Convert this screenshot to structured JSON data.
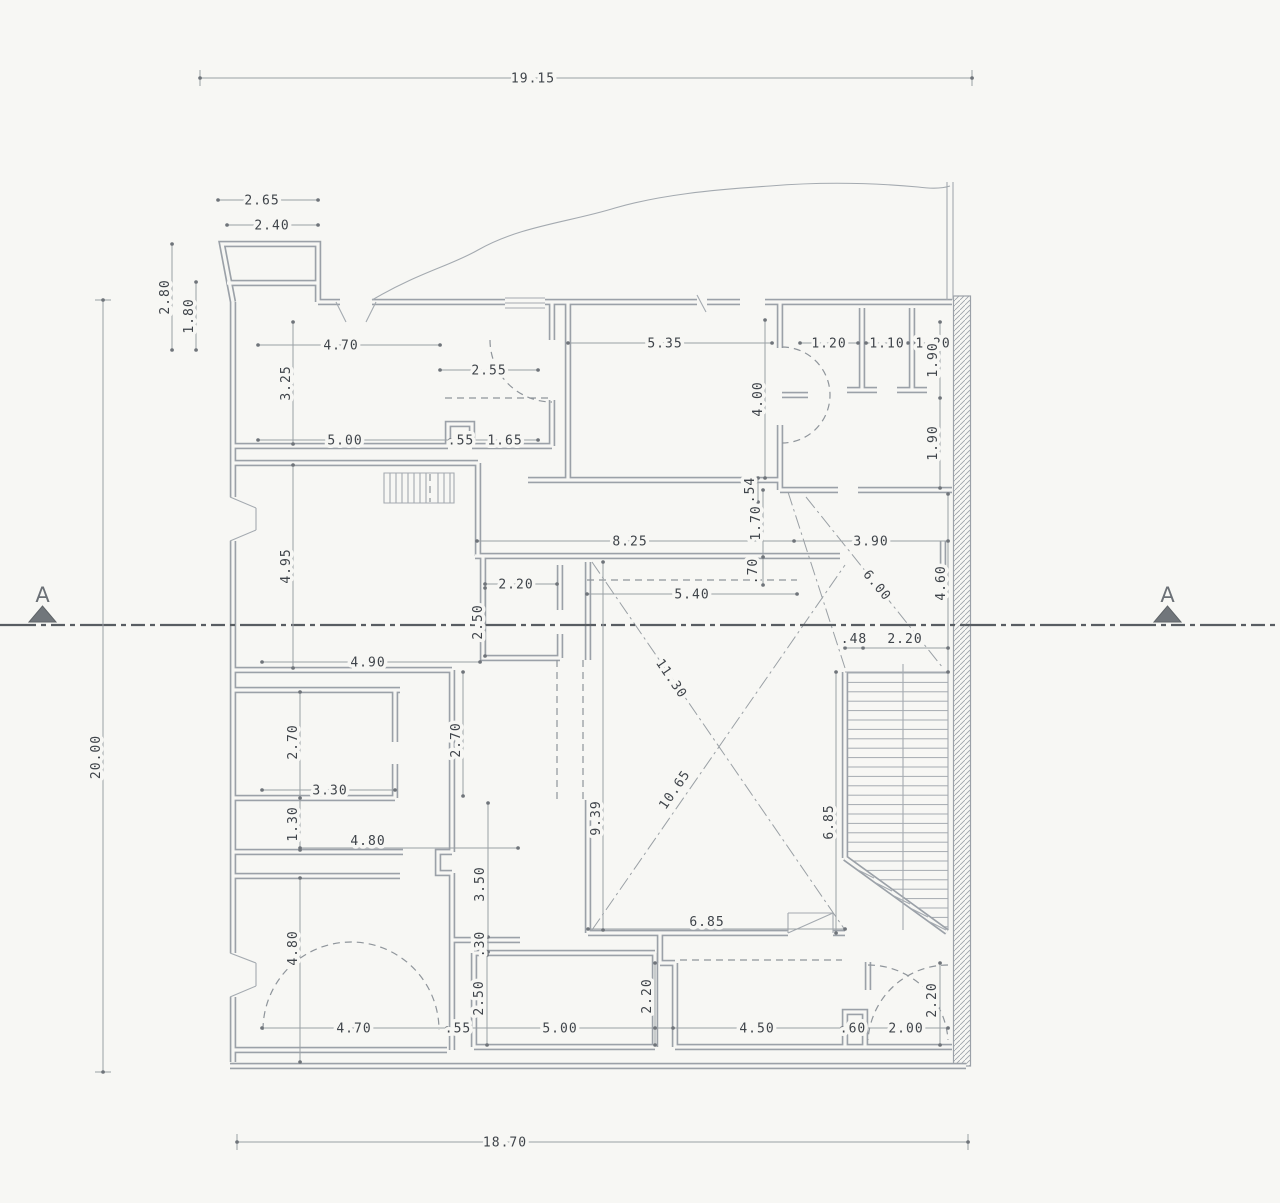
{
  "plan": {
    "section": {
      "left_label": "A",
      "right_label": "A"
    },
    "dims": {
      "overall_top": "19.15",
      "overall_bottom": "18.70",
      "overall_left": "20.00",
      "annex_w_outer": "2.65",
      "annex_w_inner": "2.40",
      "annex_h_outer": "2.80",
      "annex_h_inner": "1.80",
      "room1_top": "4.70",
      "room1_left": "3.25",
      "room1_door": "2.55",
      "room1_bottom_a": "5.00",
      "room1_bottom_b": ".55",
      "room1_bottom_c": "1.65",
      "room2_top": "5.35",
      "room2_right": "4.00",
      "room2_sill": ".54",
      "room3_a": "1.20",
      "room3_b": "1.10",
      "room3_c": "1.20",
      "room3_right_upper": "1.90",
      "room3_right_lower": "1.90",
      "hall_width": "8.25",
      "hall_right": "3.90",
      "hall_depth": "1.70",
      "hall_step": ".70",
      "hall_diag": "6.00",
      "stair_hall": "4.60",
      "stair_top_a": ".48",
      "stair_top_b": "2.20",
      "room4_left": "4.95",
      "room4_bottom": "4.90",
      "cab_w": "2.20",
      "cab_h": "2.50",
      "court_top": "5.40",
      "court_left": "9.39",
      "court_diag_a": "11.30",
      "court_diag_b": "10.65",
      "court_bottom": "6.85",
      "stair_run": "6.85",
      "room5_h": "2.70",
      "room5_bottom": "3.30",
      "strip_h": "1.30",
      "strip_w": "4.80",
      "room7_h": "4.80",
      "mid_h": "2.70",
      "mid_passage": "3.50",
      "mid_wall": ".30",
      "bottom_a": "4.70",
      "bottom_b": ".55",
      "bottom_c": "5.00",
      "bottom_d": "4.50",
      "bottom_e": ".60",
      "bottom_f": "2.00",
      "room8_left": "2.50",
      "room8_right": "2.20",
      "room9_right": "2.20"
    }
  }
}
